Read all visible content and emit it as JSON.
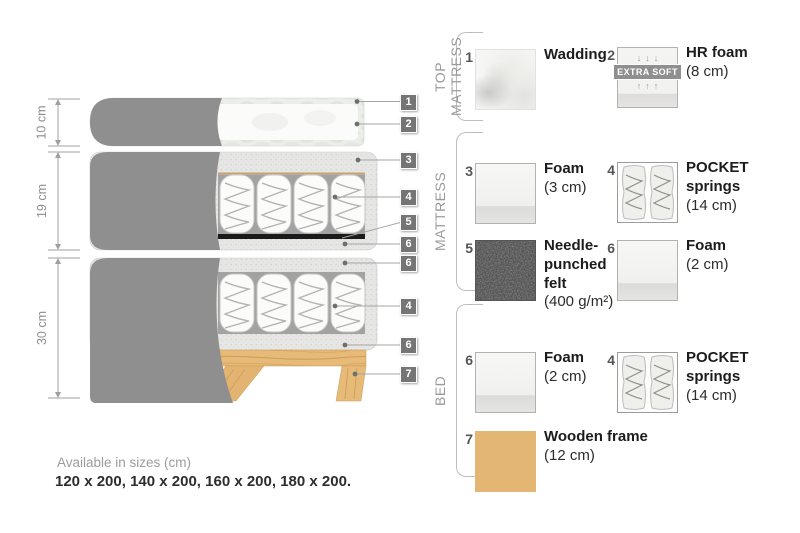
{
  "diagram": {
    "dimensions": [
      {
        "label": "10 cm"
      },
      {
        "label": "19 cm"
      },
      {
        "label": "30 cm"
      }
    ],
    "callouts": [
      {
        "number": "1"
      },
      {
        "number": "2"
      },
      {
        "number": "3"
      },
      {
        "number": "4"
      },
      {
        "number": "5"
      },
      {
        "number": "6"
      },
      {
        "number": "6"
      },
      {
        "number": "4"
      },
      {
        "number": "6"
      },
      {
        "number": "7"
      }
    ]
  },
  "legend": {
    "sections": [
      {
        "label": "TOP MATTRESS",
        "items": [
          {
            "number": "1",
            "swatch": "wadding-texture",
            "name": "Wadding",
            "size": ""
          },
          {
            "number": "2",
            "swatch": "hr-foam-extra-soft",
            "name": "HR foam",
            "size": "(8 cm)",
            "badge": "EXTRA SOFT",
            "arrows_down": "↓↓↓",
            "arrows_up": "↑↑↑"
          }
        ]
      },
      {
        "label": "MATTRESS",
        "items": [
          {
            "number": "3",
            "swatch": "foam-block",
            "name": "Foam",
            "size": "(3 cm)"
          },
          {
            "number": "4",
            "swatch": "pocket-springs",
            "name": "POCKET springs",
            "size": "(14 cm)"
          },
          {
            "number": "5",
            "swatch": "needle-punched-felt",
            "name": "Needle-punched felt",
            "size": "(400 g/m²)"
          },
          {
            "number": "6",
            "swatch": "foam-block",
            "name": "Foam",
            "size": "(2 cm)"
          }
        ]
      },
      {
        "label": "BED",
        "items": [
          {
            "number": "6",
            "swatch": "foam-block",
            "name": "Foam",
            "size": "(2 cm)"
          },
          {
            "number": "4",
            "swatch": "pocket-springs",
            "name": "POCKET springs",
            "size": "(14 cm)"
          },
          {
            "number": "7",
            "swatch": "wood-grain",
            "name": "Wooden frame",
            "size": "(12 cm)"
          }
        ]
      }
    ]
  },
  "footer": {
    "sizes_title": "Available in sizes (cm)",
    "sizes_list": "120 x 200, 140 x 200, 160 x 200, 180 x 200."
  },
  "colors": {
    "fabric_gray": "#8f8f8f",
    "badge_gray": "#757575",
    "wood": "#e3b674",
    "felt_dark": "#3f3f3f",
    "accent_tan_line": "#c8a269",
    "bracket_gray": "#bdbdbd"
  }
}
